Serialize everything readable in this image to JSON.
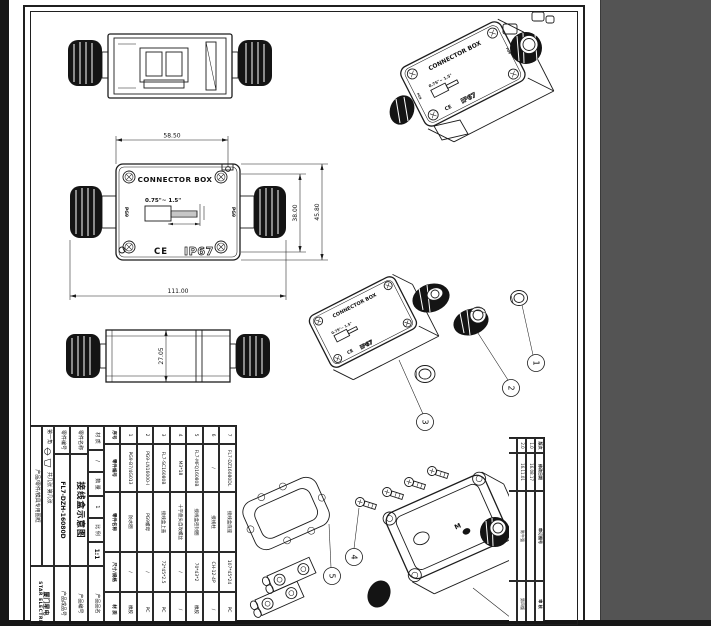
{
  "labels": {
    "product": "CONNECTOR BOX",
    "size_range": "0.75\"~ 1.5\"",
    "ce": "CE",
    "ip_rating": "IP67",
    "gland": "PG9",
    "m_mark": "M"
  },
  "dimensions": {
    "top_width": "58.50",
    "overall_length": "111.00",
    "inner_height": "38.00",
    "overall_height": "45.80",
    "body_thickness": "27.05"
  },
  "callouts": {
    "n1": "1",
    "n2": "2",
    "n3": "3",
    "n4": "4",
    "n5": "5"
  },
  "bom": {
    "headers": [
      "序号",
      "零件编号",
      "零件名称",
      "尺寸/规格",
      "材 质"
    ],
    "rows": [
      [
        "1",
        "PG9-B7/4G013",
        "防水圈",
        "/",
        "橡胶"
      ],
      [
        "2",
        "PG9-LN16000-I",
        "PG9螺母",
        "/",
        "PC"
      ],
      [
        "3",
        "FL7-SC16080B",
        "接线盒上盖",
        "72*45*2.5",
        "PC"
      ],
      [
        "4",
        "M3*18",
        "十字盘头自攻螺丝",
        "/",
        "/"
      ],
      [
        "5",
        "FL7-MFQ16080B",
        "接线盒密封圈",
        "70*43*2",
        "橡胶"
      ],
      [
        "6",
        "/",
        "接线柱",
        "CH-12-4P",
        "/"
      ],
      [
        "7",
        "FL7-DZ16080DL",
        "接线盒底座",
        "107*45*24",
        "PC"
      ]
    ]
  },
  "title_block": {
    "material_label": "材 质",
    "material_value": "/",
    "qty_label": "数 量",
    "qty_value": "1",
    "scale_label": "比 例",
    "scale_value": "1:1",
    "part_name_label": "零件名称",
    "part_name_value": "接线盒示意图",
    "part_no_label": "零件编号",
    "part_no_value": "FL7-DZH-16080D",
    "projection_label": "第一角",
    "sheets_label": "共几张  第几张",
    "frame_label": "产品/零件/模具专用图框",
    "product_name_label": "产品品名",
    "product_no_label": "产品编号",
    "product_fin_label": "产品成品号",
    "company_cn": "厦门星电",
    "company_en": "STAR ELECTRIC"
  },
  "revision_block": {
    "headers": [
      "版次",
      "修改日期",
      "审订图号",
      "审 核"
    ],
    "rows": [
      [
        "1.0",
        "16.08.17",
        "",
        ""
      ],
      [
        "2.0",
        "16.11.01",
        "陈午强",
        "第四版"
      ],
      [
        "",
        "",
        "",
        ""
      ]
    ]
  }
}
